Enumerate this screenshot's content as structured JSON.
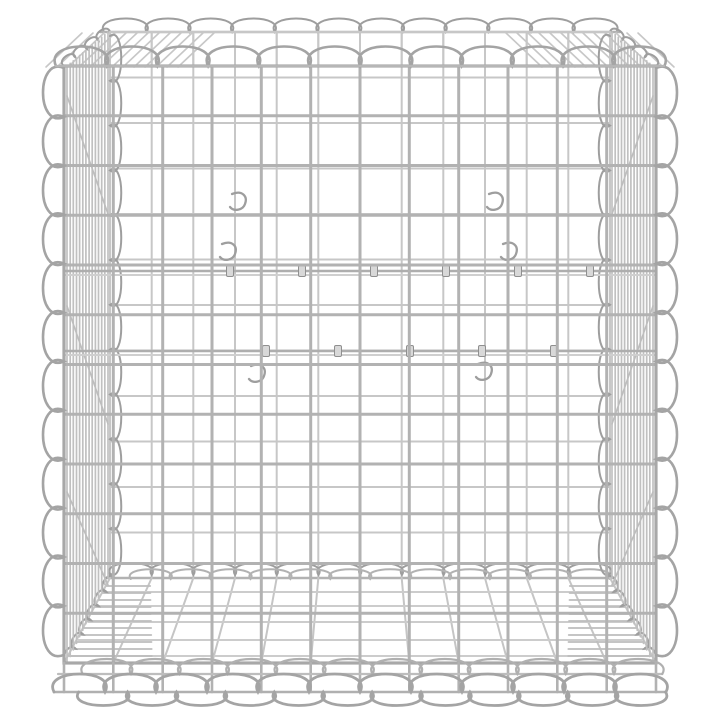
{
  "image": {
    "alt": "Galvanized silver steel gabion basket cube with spiral-wound edges on a white background",
    "subject": "gabion wire mesh basket",
    "finish": "galvanized silver",
    "background_color": "#ffffff"
  },
  "scene": {
    "canvas": {
      "w": 720,
      "h": 720
    },
    "palette": {
      "wire_back": "#c7c7c7",
      "wire_light": "#cccccc",
      "wire_mid": "#b2b2b2",
      "wire_dark": "#9e9e9e",
      "wire_spiral": "#a4a4a4",
      "wire_floor": "#c5c5c5",
      "wire_rung": "#bdbdbd",
      "clip_fill": "#d8d8d8",
      "clip_stroke": "#8f8f8f"
    },
    "front": {
      "x0": 64,
      "x1": 656,
      "y0": 66,
      "y1": 663,
      "cols": 12,
      "rows": 12
    },
    "back": {
      "x0": 110,
      "x1": 610,
      "y0": 32,
      "y1": 578,
      "cols": 12,
      "rows": 12
    },
    "spirals": {
      "front_top_h": 26,
      "back_top_h": 18,
      "front_side_h": 28,
      "back_side_h": 15,
      "back_bottom_h": 16,
      "bottom_up_h": 24,
      "bottom_down_h": 18,
      "bottom_rail_y": 692,
      "bottom_mid_rail_y": 674,
      "rim_diag_pitch": 14,
      "rim_diag_h": 9,
      "floor_diag_pitch": 16,
      "floor_diag_h": 10
    },
    "rails": [
      {
        "y": 271,
        "clips": [
          230,
          302,
          374,
          446,
          518,
          590
        ]
      },
      {
        "y": 351,
        "clips": [
          266,
          338,
          410,
          482,
          554
        ]
      }
    ],
    "hooks": [
      [
        232,
        194
      ],
      [
        489,
        194
      ],
      [
        222,
        244
      ],
      [
        503,
        244
      ],
      [
        251,
        366
      ],
      [
        478,
        364
      ]
    ],
    "floor": {
      "rungs_y": [
        592,
        606,
        622,
        640,
        656
      ],
      "ladder_y0": 586,
      "ladder_y1": 658,
      "ladder_step": 7,
      "ladder_w_near": 88,
      "ladder_w_far": 40
    },
    "side_mesh": {
      "wires": 14,
      "diag_count": 3
    },
    "top_hatch": {
      "step": 11,
      "run": 36,
      "left_limit": 188,
      "right_limit": 532
    }
  }
}
